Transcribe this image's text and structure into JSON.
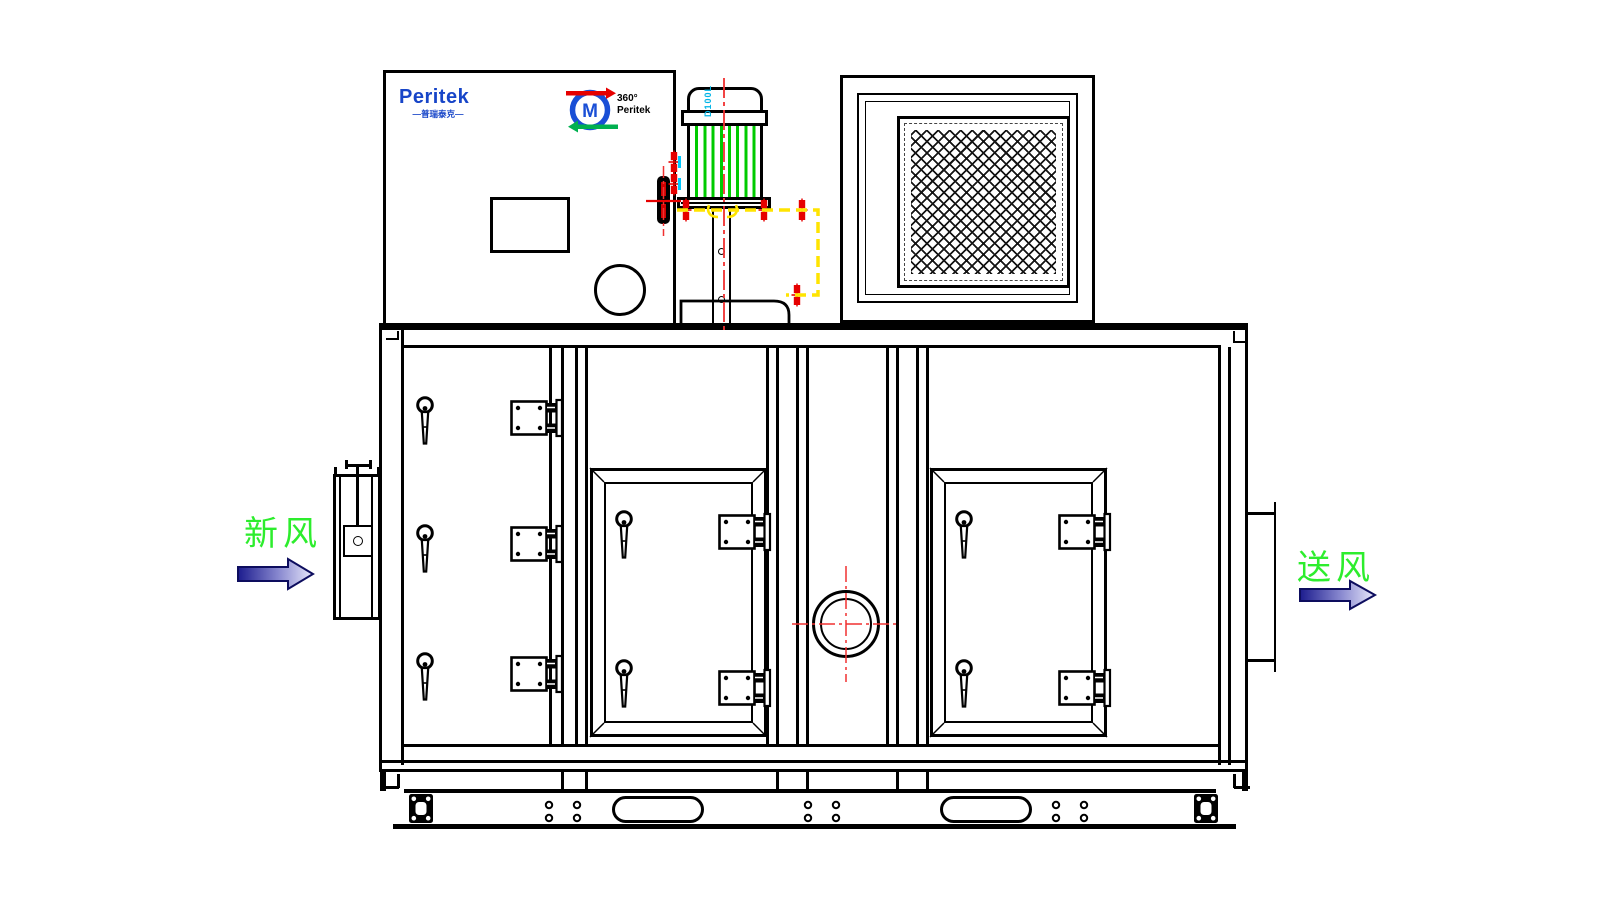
{
  "logo": {
    "brand": "Peritek",
    "subtitle": "普瑞泰克",
    "emblem_text_1": "360°",
    "emblem_text_2": "Peritek"
  },
  "motor": {
    "model_label": "D100L"
  },
  "flow_labels": {
    "inlet": "新风",
    "outlet": "送风"
  },
  "colors": {
    "line_black": "#000000",
    "centerline_red": "#f03030",
    "bolt_red": "#e60000",
    "motor_stripe_green": "#00cb00",
    "dashed_yellow": "#ffe400",
    "flow_label_green": "#2ded2d",
    "logo_blue": "#1745c8",
    "cyan_accent": "#00c8ff",
    "arrow_dark_blue": "#1c1c8e",
    "arrow_light_blue": "#e8e8fa"
  }
}
